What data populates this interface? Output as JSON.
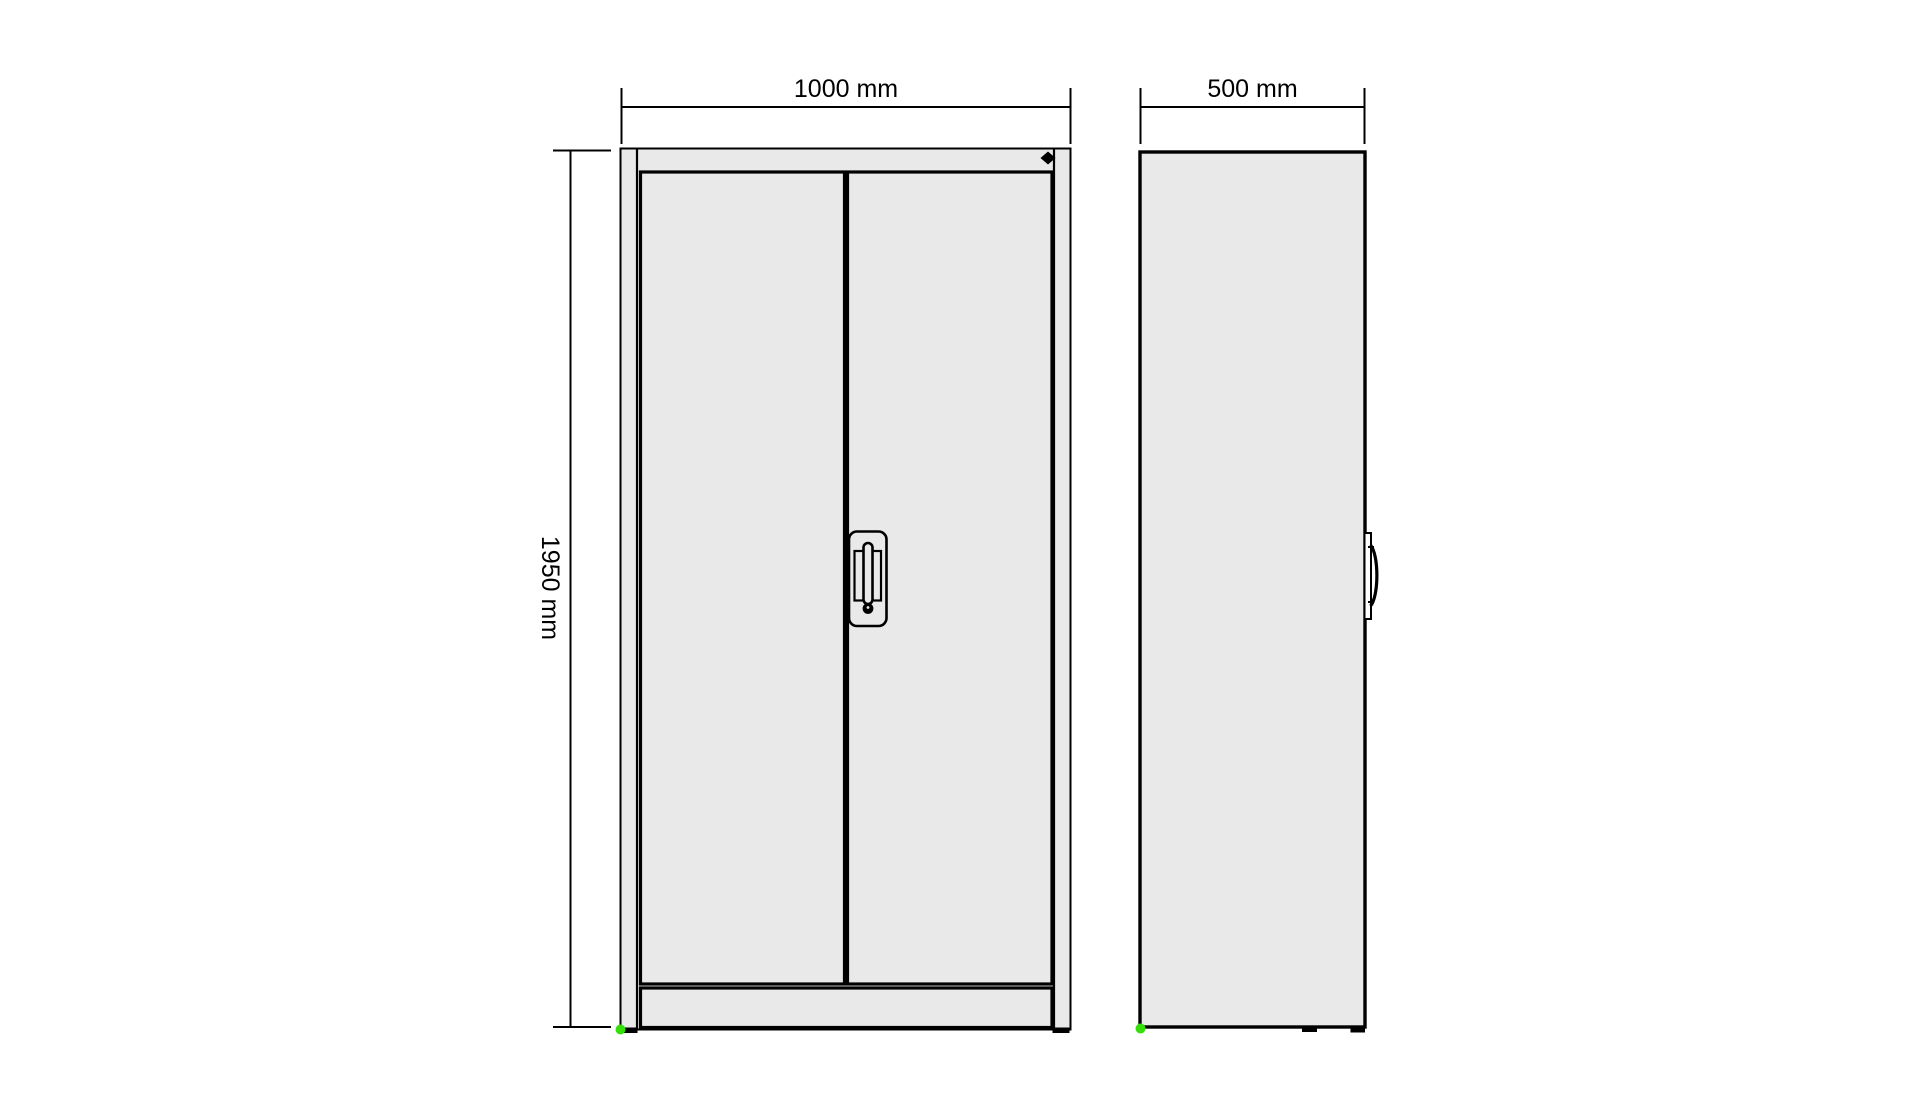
{
  "colors": {
    "background": "#ffffff",
    "line": "#000000",
    "cabinet_fill": "#e9e9e9",
    "origin_marker": "#36df0b",
    "lock_marker": "#000000"
  },
  "views": {
    "front": {
      "width_label": "1000 mm",
      "height_label": "1950 mm"
    },
    "side": {
      "depth_label": "500 mm"
    }
  }
}
